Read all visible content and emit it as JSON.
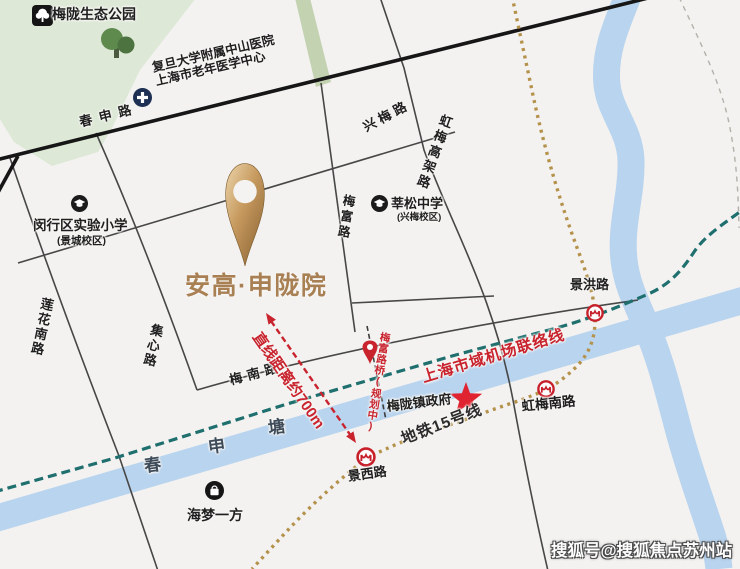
{
  "project": {
    "name": "安高·申陇院",
    "pin_icon": "gold-location-pin",
    "distance_label": "直线距离约700m"
  },
  "park": {
    "name": "梅陇生态公园",
    "icon": "tree-icon"
  },
  "hospital": {
    "icon": "medical-cross-icon",
    "line1": "复旦大学附属中山医院",
    "line2": "上海市老年医学中心"
  },
  "schools": {
    "minhang_primary": {
      "name": "闵行区实验小学",
      "campus": "(景城校区)",
      "icon": "graduation-cap-icon"
    },
    "xinsong_middle": {
      "name": "莘松中学",
      "campus": "(兴梅校区)",
      "icon": "graduation-cap-icon"
    }
  },
  "mall": {
    "name": "海梦一方",
    "icon": "shopping-bag-icon"
  },
  "town_hall": {
    "name": "梅陇镇政府",
    "marker": "red-star-icon"
  },
  "roads": {
    "chunshen": "春申路",
    "xingmei": "兴梅路",
    "hongmei_elevated": "虹梅高架路",
    "meifu": "梅富路",
    "lianhua_south": "莲花南路",
    "jixin": "集心路",
    "meinan": "梅南路"
  },
  "stations": {
    "jinghong": "景洪路",
    "hongmei_south": "虹梅南路",
    "jingxi": "景西路",
    "logo": "shanghai-metro-logo"
  },
  "transit": {
    "line15_label": "地铁15号线",
    "airport_link_label": "上海市域机场联络线",
    "planned_bridge_label": "梅富路桥(规划中)",
    "planned_bridge_pin": "red-location-pin"
  },
  "river": {
    "name_chars": [
      "春",
      "申",
      "塘"
    ]
  },
  "watermark": "搜狐号@搜狐焦点苏州站",
  "colors": {
    "background": "#f3f2f0",
    "river": "#b9d4ee",
    "park": "#dde8d6",
    "road": "#454545",
    "main_road": "#161616",
    "gold_pin": "#c79a5f",
    "project_text": "#a98054",
    "red_accent": "#c9232e",
    "airport_link_line": "#1e6f6e",
    "metro_line15_dots": "#b5924c"
  }
}
